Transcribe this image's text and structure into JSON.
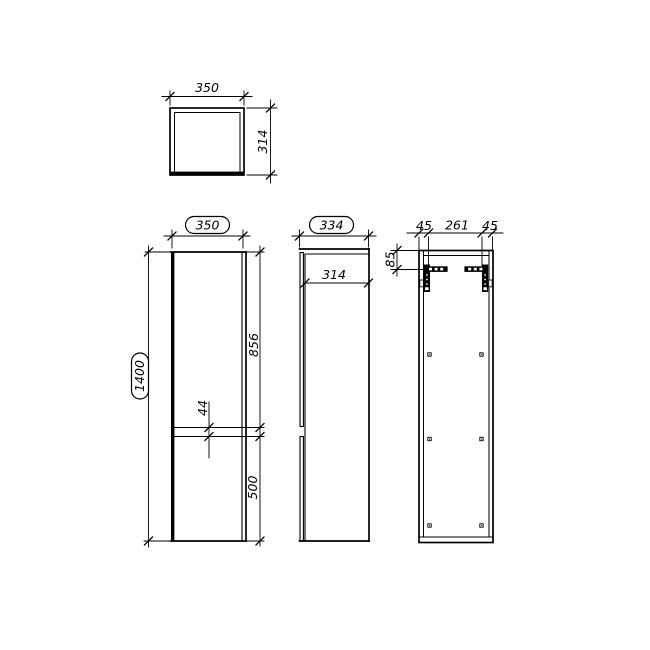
{
  "drawing": {
    "background": "#ffffff",
    "line_color": "#000000",
    "views": {
      "top": {
        "width": "350",
        "depth": "314"
      },
      "front": {
        "overall_width": "350",
        "overall_height": "1400",
        "upper_door_height": "856",
        "divider_gap": "44",
        "lower_door_height": "500"
      },
      "side": {
        "overall_depth": "334",
        "body_depth": "314"
      },
      "back": {
        "left_offset": "45",
        "bracket_span": "261",
        "right_offset": "45",
        "bracket_drop": "85"
      }
    }
  }
}
